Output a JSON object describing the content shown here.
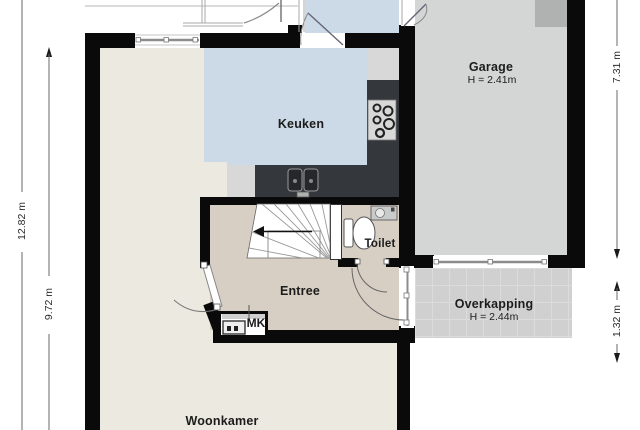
{
  "rooms": {
    "keuken": {
      "label": "Keuken"
    },
    "garage": {
      "label": "Garage",
      "height": "H = 2.41m"
    },
    "toilet": {
      "label": "Toilet"
    },
    "entree": {
      "label": "Entree"
    },
    "woonkamer": {
      "label": "Woonkamer"
    },
    "overkapping": {
      "label": "Overkapping",
      "height": "H = 2.44m"
    },
    "meterkast": {
      "label": "MK"
    }
  },
  "dimensions": {
    "left_outer": "12.82 m",
    "left_inner": "9.72 m",
    "right_garage": "7.31 m",
    "right_overkapping": "1.32 m"
  },
  "fixtures": [
    "staircase",
    "stairs-direction-arrow",
    "toilet",
    "washbasin",
    "kitchen-sink",
    "cooktop",
    "meter-cabinet",
    "door-swings",
    "windows"
  ],
  "colors": {
    "wall": "#0a0a0a",
    "floor_woonkamer": "#ece9e0",
    "floor_entree": "#d8cfc4",
    "floor_kitchen": "#cbdae6",
    "floor_garage": "#d4d5d5",
    "floor_overkapping": "#d0d0d0",
    "counter_dark": "#34373b",
    "counter_light": "#d8d8d8",
    "text": "#1c1c1c"
  }
}
